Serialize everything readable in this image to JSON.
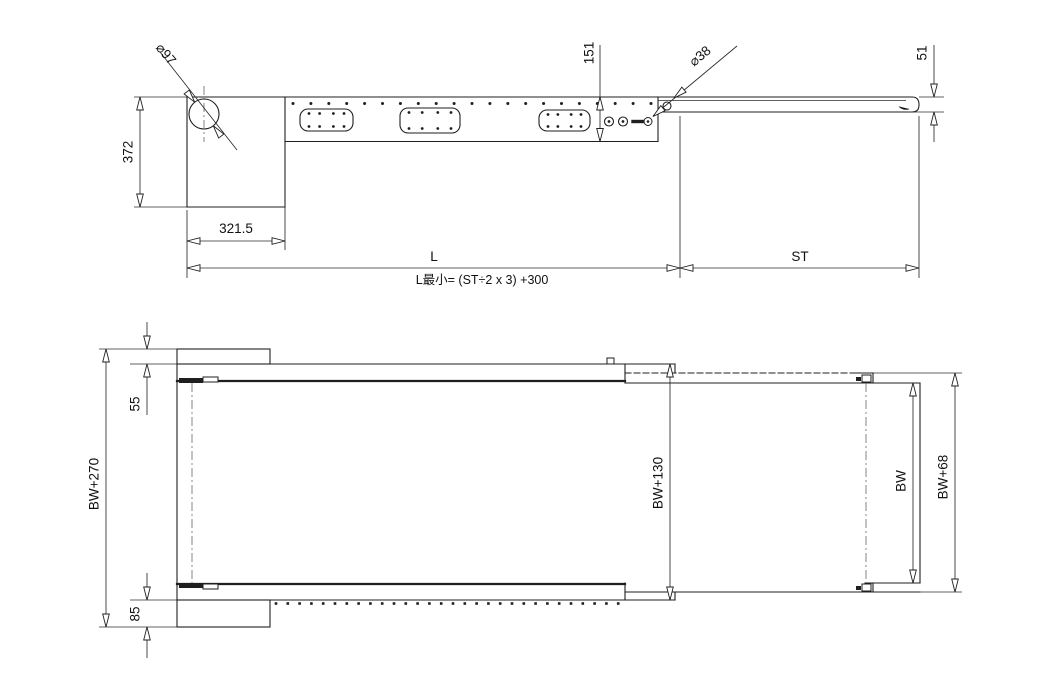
{
  "colors": {
    "line": "#1f1f1f",
    "background": "#ffffff",
    "accent_fill": "#000000"
  },
  "side_view": {
    "pulley_diameter": "⌀97",
    "frame_depth": "151",
    "roller_diameter": "⌀38",
    "boom_thickness": "51",
    "tail_height": "372",
    "tail_length": "321.5",
    "boom_length_label": "L",
    "min_length_formula": "L最小= (ST÷2 x 3) +300",
    "stroke_label": "ST"
  },
  "plan_view": {
    "overall_width": "BW+270",
    "top_offset": "55",
    "bottom_offset": "85",
    "frame_width": "BW+130",
    "belt_width": "BW",
    "boom_width": "BW+68"
  }
}
